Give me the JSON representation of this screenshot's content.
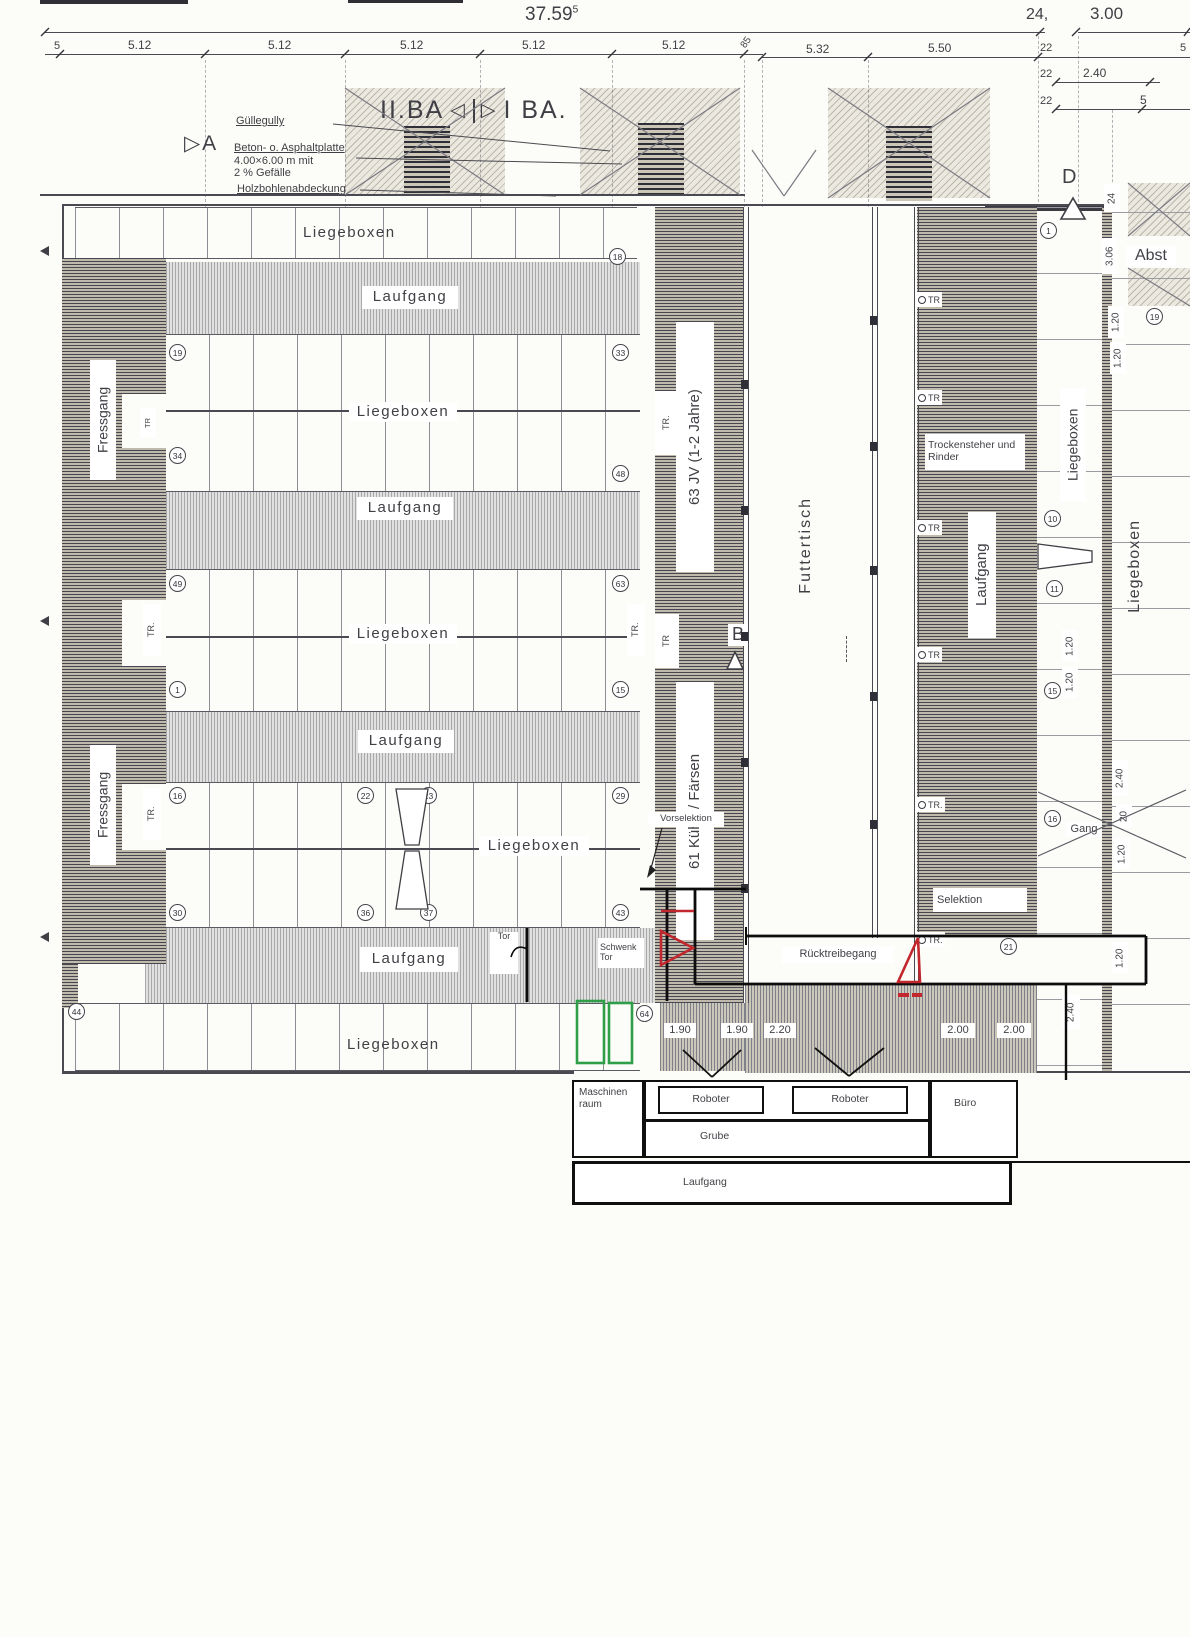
{
  "icons": {
    "cut_triangle_left": "◁",
    "cut_triangle_right": "▷"
  },
  "colors": {
    "ink": "#3f3f45",
    "pen_black": "#101010",
    "pen_red": "#c1272d",
    "pen_green": "#2f9e49"
  },
  "dims": {
    "total": "37.59",
    "total_sup": "5",
    "right_total": "24,",
    "right_total2": "3.00",
    "seg": [
      "5",
      "5.12",
      "5.12",
      "5.12",
      "5.12",
      "5.12",
      "85",
      "5.32",
      "5.50",
      "22",
      "5"
    ],
    "sub1_a": "22",
    "sub1_b": "2.40",
    "sub2_a": "22",
    "sub2_b": "5",
    "d120": "1.20",
    "d240": "2.40",
    "d20": "20",
    "d24": "24",
    "d306": "3.06",
    "bottom": [
      "1.90",
      "1.90",
      "2.20",
      "2.00",
      "2.00"
    ]
  },
  "ann": {
    "a": "A",
    "b": "B",
    "d": "D",
    "ba_left": "II.BA",
    "ba_right": "I BA.",
    "guelle": "Güllegully",
    "beton1": "Beton- o. Asphaltplatte",
    "beton2": "4.00×6.00 m  mit",
    "beton3": "2 % Gefälle",
    "holz": "Holzbohlenabdeckung"
  },
  "rooms": {
    "liegeboxen": "Liegeboxen",
    "laufgang": "Laufgang",
    "fressgang": "Fressgang",
    "futtertisch": "Futtertisch",
    "jv": "63 JV (1-2 Jahre)",
    "kuehe": "61 Kühe / Färsen",
    "trocken1": "Trockensteher und",
    "trocken2": "Rinder",
    "selektion": "Selektion",
    "vorselektion": "Vorselektion",
    "rueck": "Rücktreibegang",
    "gang": "Gang",
    "abst": "Abst"
  },
  "marks": {
    "tr": "TR",
    "trdot": "TR.",
    "fa": "FA",
    "tor": "Tor",
    "schwenk1": "Schwenk",
    "schwenk2": "Tor"
  },
  "annex": {
    "masch1": "Maschinen",
    "masch2": "raum",
    "roboter": "Roboter",
    "grube": "Grube",
    "buero": "Büro",
    "laufgang": "Laufgang"
  },
  "circles": {
    "n1": "1",
    "n10": "10",
    "n11": "11",
    "n15": "15",
    "n16": "16",
    "n18": "18",
    "n19": "19",
    "n21": "21",
    "n22": "22",
    "n23": "23",
    "n29": "29",
    "n30": "30",
    "n33": "33",
    "n34": "34",
    "n36": "36",
    "n37": "37",
    "n43": "43",
    "n44": "44",
    "n48": "48",
    "n49": "49",
    "n63": "63",
    "n64": "64"
  }
}
